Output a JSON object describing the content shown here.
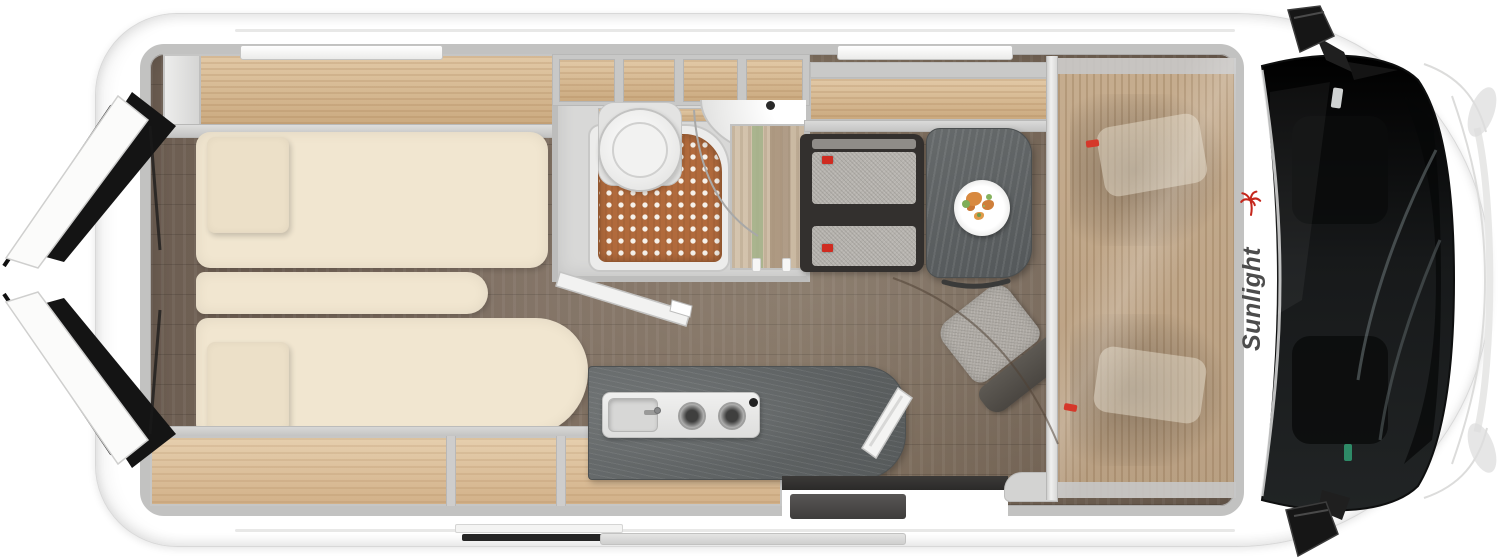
{
  "logo": {
    "text": "Sunlight",
    "text_color": "#4c4c4c",
    "accent_color": "#c5271c",
    "icon": "palm-tree-icon"
  },
  "palette": {
    "body_white": "#ffffff",
    "wall_gray": "#c2c2c1",
    "wood_cabinet": "#d9bd98",
    "wood_floor": "#79695c",
    "upholstery_cream": "#f1e6d0",
    "counter_granite": "#5f6364",
    "table_gray": "#5d6162",
    "shower_mat_terracotta": "#b16a3c",
    "bench_fabric": "#b6b3ae",
    "cab_glass_dark": "#17191a",
    "accent_red": "#d5382a"
  }
}
